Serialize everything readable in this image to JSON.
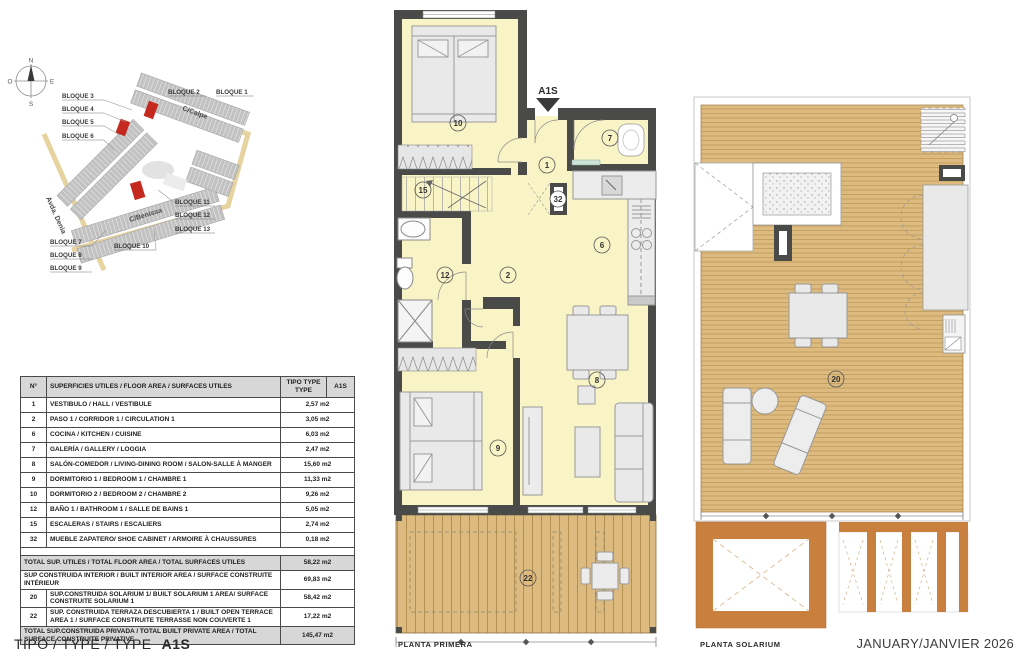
{
  "doc": {
    "type_label": "TIPO / TYPE / TYPE",
    "type_value": "A1S",
    "date": "JANUARY/JANVIER 2026"
  },
  "site_plan": {
    "compass": {
      "n": "N",
      "e": "E",
      "s": "S",
      "o": "O"
    },
    "street_calpe": "C/Calpe",
    "street_benissa": "C/Benissa",
    "street_denia": "Avda. Denia",
    "blocks": [
      "BLOQUE 1",
      "BLOQUE 2",
      "BLOQUE 3",
      "BLOQUE 4",
      "BLOQUE 5",
      "BLOQUE 6",
      "BLOQUE 7",
      "BLOQUE 8",
      "BLOQUE 9",
      "BLOQUE 10",
      "BLOQUE 11",
      "BLOQUE 12",
      "BLOQUE 13"
    ]
  },
  "areas_table": {
    "header": {
      "num": "N°",
      "desc": "SUPERFICIES UTILES / FLOOR AREA / SURFACES UTILES",
      "tipo": "TIPO TYPE TYPE",
      "type_col": "A1S"
    },
    "rows": [
      {
        "num": "1",
        "desc": "VESTIBULO / HALL  /  VESTIBULE",
        "value": "2,57 m2"
      },
      {
        "num": "2",
        "desc": "PASO 1  / CORRIDOR 1  / CIRCULATION 1",
        "value": "3,05 m2"
      },
      {
        "num": "6",
        "desc": "COCINA / KITCHEN / CUISINE",
        "value": "6,03 m2"
      },
      {
        "num": "7",
        "desc": "GALERÍA / GALLERY / LOGGIA",
        "value": "2,47 m2"
      },
      {
        "num": "8",
        "desc": "SALÓN-COMEDOR  /  LIVING-DINING ROOM /  SALON-SALLE À MANGER",
        "value": "15,60 m2"
      },
      {
        "num": "9",
        "desc": "DORMITORIO 1 / BEDROOM 1 / CHAMBRE 1",
        "value": "11,33 m2"
      },
      {
        "num": "10",
        "desc": "DORMITORIO 2 / BEDROOM 2 / CHAMBRE 2",
        "value": "9,26 m2"
      },
      {
        "num": "12",
        "desc": "BAÑO 1 / BATHROOM 1 / SALLE DE BAINS 1",
        "value": "5,05 m2"
      },
      {
        "num": "15",
        "desc": "ESCALERAS / STAIRS / ESCALIERS",
        "value": "2,74 m2"
      },
      {
        "num": "32",
        "desc": "MUEBLE ZAPATERO/ SHOE CABINET / ARMOIRE À CHAUSSURES",
        "value": "0,18 m2"
      }
    ],
    "totals": [
      {
        "num": "",
        "desc": "TOTAL SUP. UTILES / TOTAL FLOOR AREA / TOTAL SURFACES UTILES",
        "value": "58,22 m2"
      },
      {
        "num": "",
        "desc": "SUP CONSTRUIDA INTERIOR / BUILT INTERIOR AREA / SURFACE CONSTRUITE INTÉRIEUR",
        "value": "69,83 m2"
      },
      {
        "num": "20",
        "desc": "SUP.CONSTRUIDA SOLARIUM 1/ BUILT SOLARIUM 1 AREA/ SURFACE CONSTRUITE SOLARIUM 1",
        "value": "58,42 m2"
      },
      {
        "num": "22",
        "desc": "SUP. CONSTRUIDA TERRAZA DESCUBIERTA 1 / BUILT OPEN TERRACE AREA 1 / SURFACE CONSTRUITE TERRASSE NON COUVERTE 1",
        "value": "17,22 m2"
      },
      {
        "num": "",
        "desc": "TOTAL SUP.CONSTRUIDA PRIVADA / TOTAL  BUILT PRIVATE AREA / TOTAL SURFACE CONSTRUITE PRIVATIVE",
        "value": "145,47 m2"
      }
    ]
  },
  "plan_primera": {
    "title": "PLANTA PRIMERA",
    "unit_marker": "A1S",
    "room_labels": {
      "hall": "1",
      "corridor": "2",
      "kitchen": "6",
      "gallery": "7",
      "living": "8",
      "bedroom1": "9",
      "bedroom2": "10",
      "bathroom": "12",
      "stairs": "15",
      "shoe_cabinet": "32",
      "terrace": "22"
    }
  },
  "plan_solarium": {
    "title": "PLANTA SOLARIUM",
    "room_labels": {
      "solarium": "20"
    }
  },
  "colors": {
    "room_fill": "#f9f4c5",
    "wall": "#4a4a48",
    "deck": "#dcba80",
    "deck_line": "#b3904f",
    "terracotta": "#c9803f",
    "furniture": "#e9e9e9",
    "highlight_red": "#c4281e",
    "table_header_bg": "#d7d7d7"
  }
}
